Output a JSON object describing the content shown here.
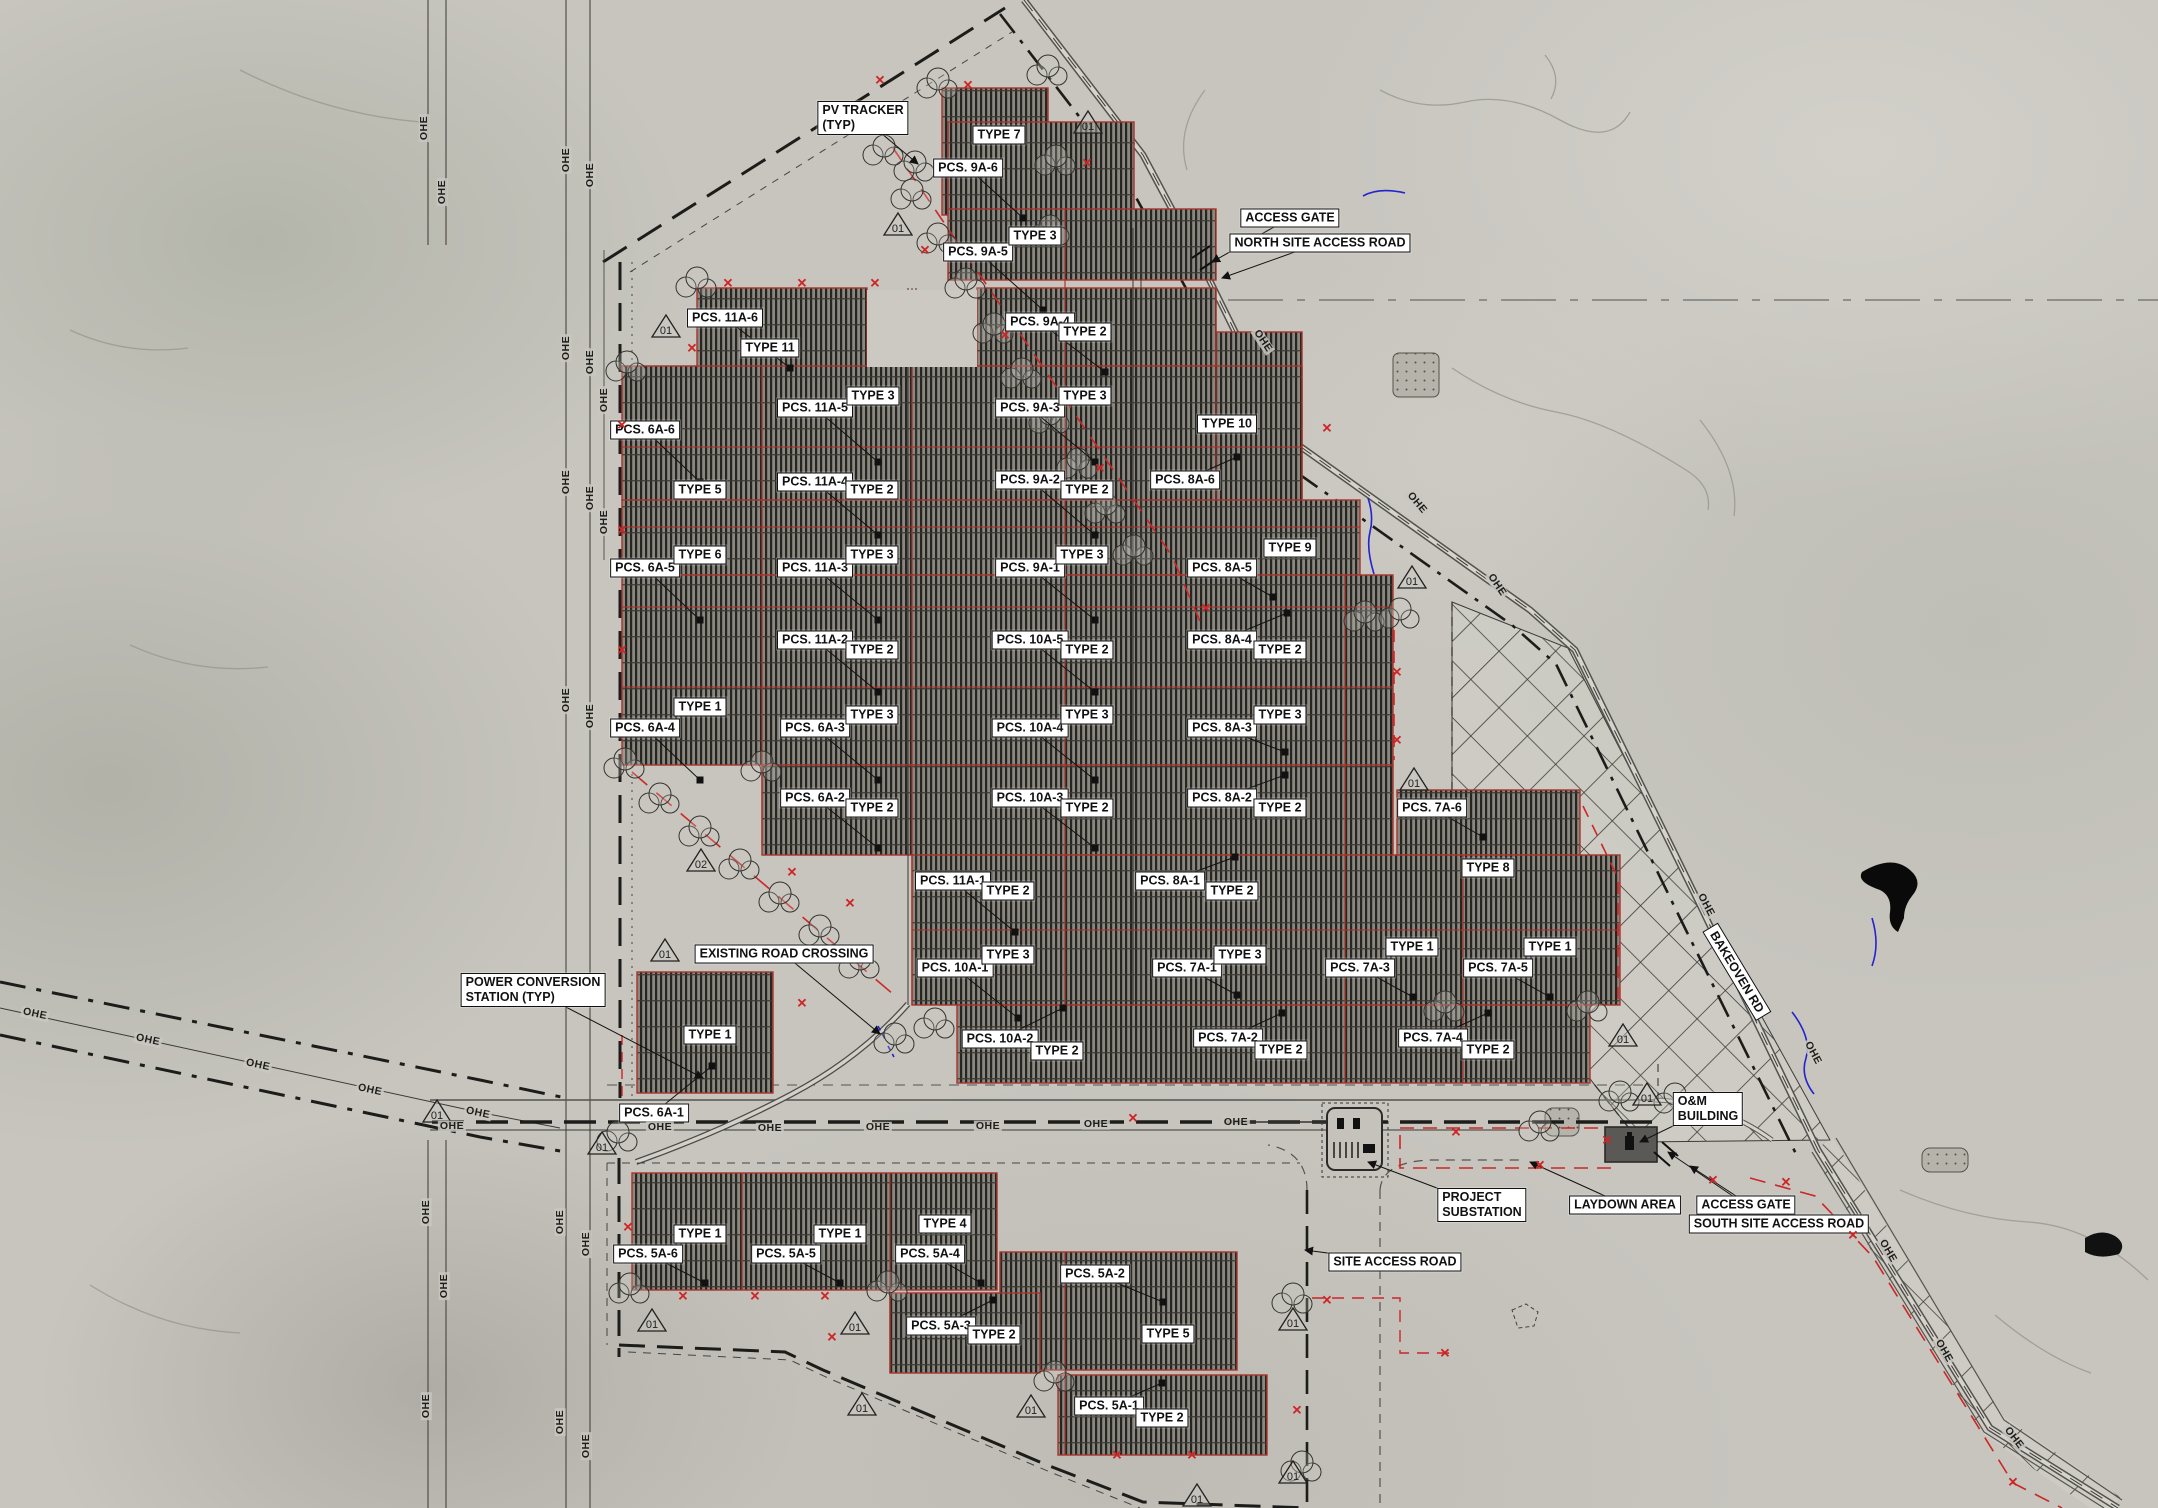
{
  "drawing": {
    "ohe_text": "OHE",
    "colors": {
      "boundary_red": "#cc2626",
      "label_bg": "#ffffff",
      "label_border": "#111111",
      "array_hatch": "#8a8781",
      "terrain": "#c7c5be",
      "water_blue": "#2323cf"
    },
    "pcs_labels": [
      {
        "t": "PCS. 9A-6",
        "x": 968,
        "y": 168,
        "tx": 1023,
        "ty": 218
      },
      {
        "t": "PCS. 9A-5",
        "x": 978,
        "y": 252,
        "tx": 1043,
        "ty": 310
      },
      {
        "t": "PCS. 9A-4",
        "x": 1040,
        "y": 322,
        "tx": 1105,
        "ty": 372
      },
      {
        "t": "PCS. 9A-3",
        "x": 1030,
        "y": 408,
        "tx": 1095,
        "ty": 462
      },
      {
        "t": "PCS. 9A-2",
        "x": 1030,
        "y": 480,
        "tx": 1095,
        "ty": 535
      },
      {
        "t": "PCS. 9A-1",
        "x": 1030,
        "y": 568,
        "tx": 1095,
        "ty": 620
      },
      {
        "t": "PCS. 11A-6",
        "x": 725,
        "y": 318,
        "tx": 790,
        "ty": 368
      },
      {
        "t": "PCS. 11A-5",
        "x": 815,
        "y": 408,
        "tx": 878,
        "ty": 462
      },
      {
        "t": "PCS. 11A-4",
        "x": 815,
        "y": 482,
        "tx": 878,
        "ty": 535
      },
      {
        "t": "PCS. 11A-3",
        "x": 815,
        "y": 568,
        "tx": 878,
        "ty": 620
      },
      {
        "t": "PCS. 11A-2",
        "x": 815,
        "y": 640,
        "tx": 878,
        "ty": 692
      },
      {
        "t": "PCS. 11A-1",
        "x": 953,
        "y": 881,
        "tx": 1015,
        "ty": 932
      },
      {
        "t": "PCS. 6A-6",
        "x": 645,
        "y": 430,
        "tx": 700,
        "ty": 482
      },
      {
        "t": "PCS. 6A-5",
        "x": 645,
        "y": 568,
        "tx": 700,
        "ty": 620
      },
      {
        "t": "PCS. 6A-4",
        "x": 645,
        "y": 728,
        "tx": 700,
        "ty": 780
      },
      {
        "t": "PCS. 6A-3",
        "x": 815,
        "y": 728,
        "tx": 878,
        "ty": 780
      },
      {
        "t": "PCS. 6A-2",
        "x": 815,
        "y": 798,
        "tx": 878,
        "ty": 848
      },
      {
        "t": "PCS. 6A-1",
        "x": 654,
        "y": 1113,
        "tx": 712,
        "ty": 1066
      },
      {
        "t": "PCS. 10A-5",
        "x": 1030,
        "y": 640,
        "tx": 1095,
        "ty": 692
      },
      {
        "t": "PCS. 10A-4",
        "x": 1030,
        "y": 728,
        "tx": 1095,
        "ty": 780
      },
      {
        "t": "PCS. 10A-3",
        "x": 1030,
        "y": 798,
        "tx": 1095,
        "ty": 848
      },
      {
        "t": "PCS. 10A-2",
        "x": 1000,
        "y": 1039,
        "tx": 1063,
        "ty": 1008
      },
      {
        "t": "PCS. 10A-1",
        "x": 955,
        "y": 968,
        "tx": 1018,
        "ty": 1018
      },
      {
        "t": "PCS. 8A-6",
        "x": 1185,
        "y": 480,
        "tx": 1237,
        "ty": 457
      },
      {
        "t": "PCS. 8A-5",
        "x": 1222,
        "y": 568,
        "tx": 1273,
        "ty": 597
      },
      {
        "t": "PCS. 8A-4",
        "x": 1222,
        "y": 640,
        "tx": 1287,
        "ty": 613
      },
      {
        "t": "PCS. 8A-3",
        "x": 1222,
        "y": 728,
        "tx": 1285,
        "ty": 752
      },
      {
        "t": "PCS. 8A-2",
        "x": 1222,
        "y": 798,
        "tx": 1285,
        "ty": 775
      },
      {
        "t": "PCS. 8A-1",
        "x": 1170,
        "y": 881,
        "tx": 1235,
        "ty": 857
      },
      {
        "t": "PCS. 7A-6",
        "x": 1432,
        "y": 808,
        "tx": 1483,
        "ty": 837
      },
      {
        "t": "PCS. 7A-1",
        "x": 1187,
        "y": 968,
        "tx": 1237,
        "ty": 995
      },
      {
        "t": "PCS. 7A-3",
        "x": 1360,
        "y": 968,
        "tx": 1413,
        "ty": 997
      },
      {
        "t": "PCS. 7A-5",
        "x": 1498,
        "y": 968,
        "tx": 1550,
        "ty": 997
      },
      {
        "t": "PCS. 7A-2",
        "x": 1228,
        "y": 1038,
        "tx": 1282,
        "ty": 1013
      },
      {
        "t": "PCS. 7A-4",
        "x": 1433,
        "y": 1038,
        "tx": 1488,
        "ty": 1013
      },
      {
        "t": "PCS. 5A-6",
        "x": 648,
        "y": 1254,
        "tx": 705,
        "ty": 1283
      },
      {
        "t": "PCS. 5A-5",
        "x": 786,
        "y": 1254,
        "tx": 840,
        "ty": 1283
      },
      {
        "t": "PCS. 5A-4",
        "x": 930,
        "y": 1254,
        "tx": 981,
        "ty": 1283
      },
      {
        "t": "PCS. 5A-3",
        "x": 941,
        "y": 1326,
        "tx": 993,
        "ty": 1300
      },
      {
        "t": "PCS. 5A-2",
        "x": 1095,
        "y": 1274,
        "tx": 1163,
        "ty": 1302
      },
      {
        "t": "PCS. 5A-1",
        "x": 1109,
        "y": 1406,
        "tx": 1162,
        "ty": 1383
      }
    ],
    "type_labels": [
      {
        "t": "TYPE 7",
        "x": 999,
        "y": 135
      },
      {
        "t": "TYPE 3",
        "x": 1035,
        "y": 236
      },
      {
        "t": "TYPE 2",
        "x": 1085,
        "y": 332
      },
      {
        "t": "TYPE 11",
        "x": 770,
        "y": 348
      },
      {
        "t": "TYPE 3",
        "x": 873,
        "y": 396
      },
      {
        "t": "TYPE 3",
        "x": 1085,
        "y": 396
      },
      {
        "t": "TYPE 10",
        "x": 1227,
        "y": 424
      },
      {
        "t": "TYPE 5",
        "x": 700,
        "y": 490
      },
      {
        "t": "TYPE 2",
        "x": 872,
        "y": 490
      },
      {
        "t": "TYPE 2",
        "x": 1087,
        "y": 490
      },
      {
        "t": "TYPE 9",
        "x": 1290,
        "y": 548
      },
      {
        "t": "TYPE 6",
        "x": 700,
        "y": 555
      },
      {
        "t": "TYPE 3",
        "x": 872,
        "y": 555
      },
      {
        "t": "TYPE 3",
        "x": 1082,
        "y": 555
      },
      {
        "t": "TYPE 2",
        "x": 872,
        "y": 650
      },
      {
        "t": "TYPE 2",
        "x": 1087,
        "y": 650
      },
      {
        "t": "TYPE 2",
        "x": 1280,
        "y": 650
      },
      {
        "t": "TYPE 1",
        "x": 700,
        "y": 707
      },
      {
        "t": "TYPE 3",
        "x": 872,
        "y": 715
      },
      {
        "t": "TYPE 3",
        "x": 1087,
        "y": 715
      },
      {
        "t": "TYPE 3",
        "x": 1280,
        "y": 715
      },
      {
        "t": "TYPE 2",
        "x": 872,
        "y": 808
      },
      {
        "t": "TYPE 2",
        "x": 1087,
        "y": 808
      },
      {
        "t": "TYPE 2",
        "x": 1280,
        "y": 808
      },
      {
        "t": "TYPE 8",
        "x": 1488,
        "y": 868
      },
      {
        "t": "TYPE 2",
        "x": 1008,
        "y": 891
      },
      {
        "t": "TYPE 2",
        "x": 1232,
        "y": 891
      },
      {
        "t": "TYPE 3",
        "x": 1008,
        "y": 955
      },
      {
        "t": "TYPE 3",
        "x": 1240,
        "y": 955
      },
      {
        "t": "TYPE 1",
        "x": 1412,
        "y": 947
      },
      {
        "t": "TYPE 1",
        "x": 1550,
        "y": 947
      },
      {
        "t": "TYPE 1",
        "x": 710,
        "y": 1035
      },
      {
        "t": "TYPE 2",
        "x": 1057,
        "y": 1051
      },
      {
        "t": "TYPE 2",
        "x": 1281,
        "y": 1050
      },
      {
        "t": "TYPE 2",
        "x": 1488,
        "y": 1050
      },
      {
        "t": "TYPE 1",
        "x": 700,
        "y": 1234
      },
      {
        "t": "TYPE 1",
        "x": 840,
        "y": 1234
      },
      {
        "t": "TYPE 4",
        "x": 945,
        "y": 1224
      },
      {
        "t": "TYPE 2",
        "x": 994,
        "y": 1335
      },
      {
        "t": "TYPE 5",
        "x": 1168,
        "y": 1334
      },
      {
        "t": "TYPE 2",
        "x": 1162,
        "y": 1418
      }
    ],
    "callouts": [
      {
        "t": "PV TRACKER\n(TYP)",
        "x": 863,
        "y": 118,
        "tx": 918,
        "ty": 164
      },
      {
        "t": "ACCESS GATE",
        "x": 1290,
        "y": 218,
        "tx": 1212,
        "ty": 262
      },
      {
        "t": "NORTH SITE ACCESS ROAD",
        "x": 1320,
        "y": 243,
        "tx": 1222,
        "ty": 278
      },
      {
        "t": "EXISTING ROAD CROSSING",
        "x": 784,
        "y": 954,
        "tx": 880,
        "ty": 1034
      },
      {
        "t": "POWER CONVERSION\nSTATION (TYP)",
        "x": 533,
        "y": 990,
        "tx": 703,
        "ty": 1078
      },
      {
        "t": "O&M\nBUILDING",
        "x": 1708,
        "y": 1109,
        "tx": 1640,
        "ty": 1142
      },
      {
        "t": "PROJECT\nSUBSTATION",
        "x": 1482,
        "y": 1205,
        "tx": 1368,
        "ty": 1162
      },
      {
        "t": "LAYDOWN AREA",
        "x": 1625,
        "y": 1205,
        "tx": 1530,
        "ty": 1162
      },
      {
        "t": "ACCESS GATE",
        "x": 1746,
        "y": 1205,
        "tx": 1668,
        "ty": 1152
      },
      {
        "t": "SOUTH SITE ACCESS ROAD",
        "x": 1779,
        "y": 1224,
        "tx": 1690,
        "ty": 1166
      },
      {
        "t": "SITE ACCESS ROAD",
        "x": 1395,
        "y": 1262,
        "tx": 1305,
        "ty": 1250
      }
    ],
    "road_label": {
      "t": "BAKEOVEN RD",
      "x": 1737,
      "y": 972,
      "rot": 59
    },
    "ohe": [
      [
        566,
        160,
        -90
      ],
      [
        590,
        175,
        -90
      ],
      [
        566,
        348,
        -90
      ],
      [
        590,
        362,
        -90
      ],
      [
        604,
        400,
        -90
      ],
      [
        566,
        482,
        -90
      ],
      [
        590,
        498,
        -90
      ],
      [
        604,
        522,
        -90
      ],
      [
        566,
        700,
        -90
      ],
      [
        590,
        716,
        -90
      ],
      [
        560,
        1222,
        -90
      ],
      [
        586,
        1244,
        -90
      ],
      [
        560,
        1422,
        -90
      ],
      [
        586,
        1446,
        -90
      ],
      [
        424,
        128,
        -90
      ],
      [
        442,
        192,
        -90
      ],
      [
        426,
        1212,
        -90
      ],
      [
        444,
        1286,
        -90
      ],
      [
        426,
        1406,
        -90
      ],
      [
        452,
        1126,
        0
      ],
      [
        660,
        1127,
        0
      ],
      [
        770,
        1128,
        0
      ],
      [
        878,
        1127,
        0
      ],
      [
        988,
        1126,
        0
      ],
      [
        1096,
        1124,
        0
      ],
      [
        1236,
        1122,
        0
      ],
      [
        35,
        1014,
        12
      ],
      [
        148,
        1040,
        12
      ],
      [
        258,
        1065,
        12
      ],
      [
        370,
        1090,
        12
      ],
      [
        478,
        1113,
        12
      ],
      [
        1263,
        341,
        56
      ],
      [
        1417,
        503,
        50
      ],
      [
        1497,
        585,
        56
      ],
      [
        1706,
        905,
        62
      ],
      [
        1813,
        1053,
        62
      ],
      [
        1888,
        1251,
        60
      ],
      [
        1944,
        1351,
        60
      ],
      [
        2014,
        1438,
        52
      ]
    ],
    "triangles": [
      {
        "x": 898,
        "y": 225,
        "t": "01"
      },
      {
        "x": 1088,
        "y": 123,
        "t": "01"
      },
      {
        "x": 666,
        "y": 327,
        "t": "01"
      },
      {
        "x": 1412,
        "y": 578,
        "t": "01"
      },
      {
        "x": 1414,
        "y": 780,
        "t": "01"
      },
      {
        "x": 701,
        "y": 861,
        "t": "02"
      },
      {
        "x": 665,
        "y": 951,
        "t": "01"
      },
      {
        "x": 1623,
        "y": 1036,
        "t": "01"
      },
      {
        "x": 1647,
        "y": 1095,
        "t": "01"
      },
      {
        "x": 437,
        "y": 1112,
        "t": "01"
      },
      {
        "x": 602,
        "y": 1144,
        "t": "01"
      },
      {
        "x": 652,
        "y": 1321,
        "t": "01"
      },
      {
        "x": 855,
        "y": 1324,
        "t": "01"
      },
      {
        "x": 862,
        "y": 1405,
        "t": "01"
      },
      {
        "x": 1031,
        "y": 1407,
        "t": "01"
      },
      {
        "x": 1293,
        "y": 1320,
        "t": "01"
      },
      {
        "x": 1293,
        "y": 1473,
        "t": "01"
      },
      {
        "x": 1197,
        "y": 1496,
        "t": "01"
      }
    ],
    "x_marks": [
      [
        880,
        80
      ],
      [
        968,
        85
      ],
      [
        1087,
        163
      ],
      [
        925,
        250
      ],
      [
        1005,
        335
      ],
      [
        1100,
        468
      ],
      [
        1206,
        608
      ],
      [
        728,
        283
      ],
      [
        802,
        283
      ],
      [
        875,
        283
      ],
      [
        692,
        348
      ],
      [
        622,
        425
      ],
      [
        622,
        530
      ],
      [
        622,
        650
      ],
      [
        1327,
        428
      ],
      [
        1397,
        672
      ],
      [
        1397,
        740
      ],
      [
        792,
        872
      ],
      [
        850,
        903
      ],
      [
        802,
        1003
      ],
      [
        1456,
        1132
      ],
      [
        1540,
        1165
      ],
      [
        1607,
        1140
      ],
      [
        1713,
        1180
      ],
      [
        1786,
        1182
      ],
      [
        1853,
        1235
      ],
      [
        2013,
        1482
      ],
      [
        683,
        1296
      ],
      [
        755,
        1296
      ],
      [
        825,
        1296
      ],
      [
        832,
        1337
      ],
      [
        1117,
        1455
      ],
      [
        1192,
        1455
      ],
      [
        1297,
        1410
      ],
      [
        1327,
        1300
      ],
      [
        1445,
        1353
      ],
      [
        628,
        1227
      ],
      [
        1133,
        1118
      ]
    ],
    "clouds": [
      [
        938,
        85
      ],
      [
        1048,
        72
      ],
      [
        1056,
        162
      ],
      [
        1050,
        232
      ],
      [
        915,
        168
      ],
      [
        697,
        284
      ],
      [
        627,
        368
      ],
      [
        625,
        765
      ],
      [
        762,
        768
      ],
      [
        895,
        1040
      ],
      [
        935,
        1025
      ],
      [
        618,
        1138
      ],
      [
        630,
        1290
      ],
      [
        888,
        1288
      ],
      [
        1055,
        1378
      ],
      [
        1293,
        1300
      ],
      [
        1302,
        1468
      ],
      [
        1588,
        1008
      ],
      [
        1620,
        1098
      ],
      [
        1675,
        1100
      ],
      [
        1540,
        1128
      ],
      [
        1365,
        618
      ],
      [
        1400,
        615
      ],
      [
        884,
        152
      ],
      [
        912,
        196
      ],
      [
        938,
        240
      ],
      [
        966,
        285
      ],
      [
        994,
        330
      ],
      [
        1022,
        375
      ],
      [
        1050,
        420
      ],
      [
        1078,
        465
      ],
      [
        1106,
        510
      ],
      [
        1134,
        552
      ],
      [
        660,
        800
      ],
      [
        700,
        833
      ],
      [
        740,
        866
      ],
      [
        780,
        899
      ],
      [
        820,
        932
      ],
      [
        860,
        965
      ],
      [
        1445,
        1008
      ]
    ]
  }
}
